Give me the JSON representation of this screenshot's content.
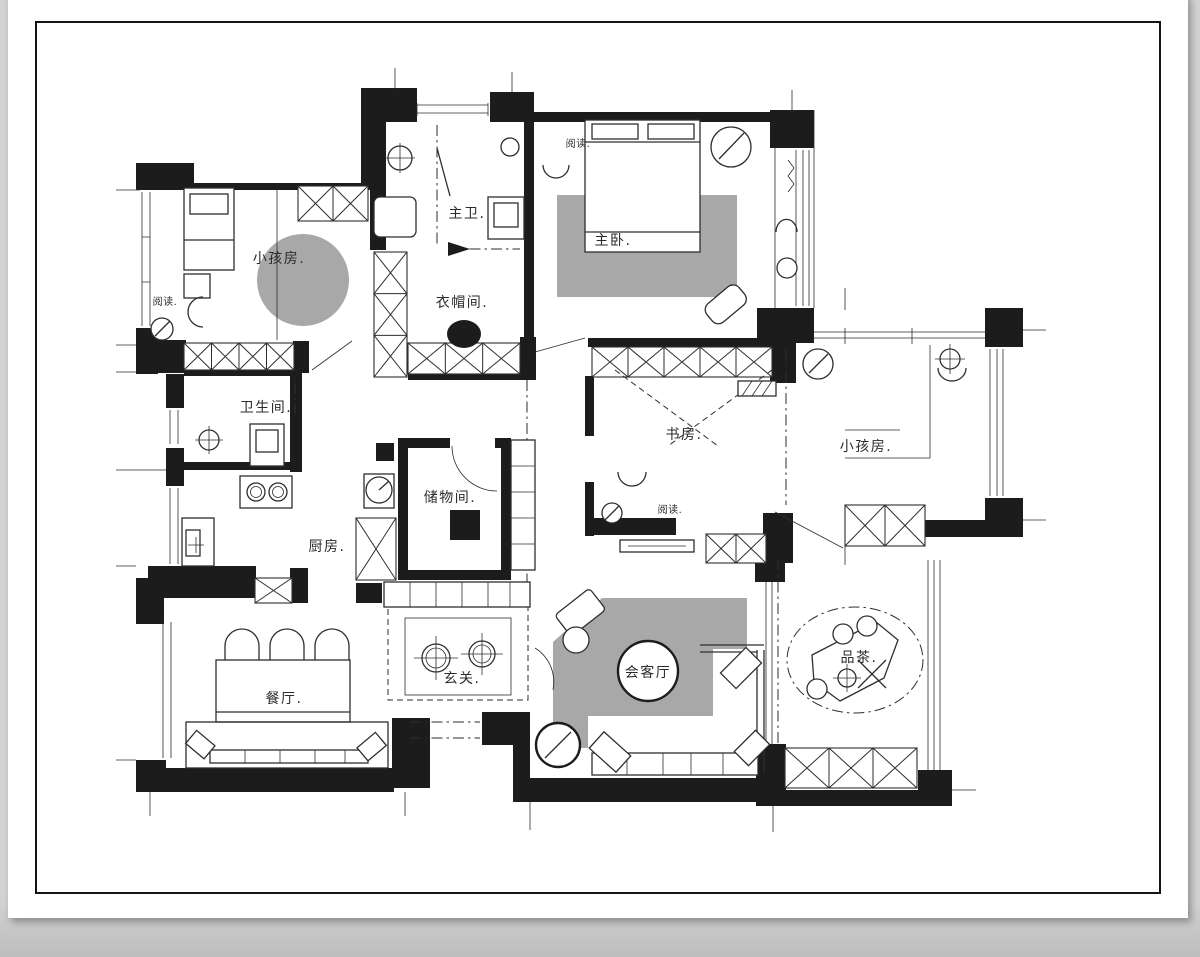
{
  "page": {
    "colors": {
      "background": "#d3d3d3",
      "sheet": "#ffffff",
      "frame": "#141414",
      "ink": "#1c1c1c",
      "line": "#2e2e2e",
      "rug": "#a8a8a8",
      "label": "#2b2b2b"
    }
  },
  "plan": {
    "rooms": [
      {
        "id": "kids-room-1",
        "label": "小孩房."
      },
      {
        "id": "master-bath",
        "label": "主卫."
      },
      {
        "id": "master-bedroom",
        "label": "主卧."
      },
      {
        "id": "walk-in-closet",
        "label": "衣帽间."
      },
      {
        "id": "bathroom",
        "label": "卫生间."
      },
      {
        "id": "study",
        "label": "书房."
      },
      {
        "id": "kids-room-2",
        "label": "小孩房."
      },
      {
        "id": "storage-room",
        "label": "储物间."
      },
      {
        "id": "kitchen",
        "label": "厨房."
      },
      {
        "id": "dining-room",
        "label": "餐厅."
      },
      {
        "id": "foyer",
        "label": "玄关."
      },
      {
        "id": "living-room",
        "label": "会客厅"
      },
      {
        "id": "tea-area",
        "label": "品茶."
      }
    ],
    "annotations": [
      {
        "id": "reading-kids-room-1",
        "label": "阅读."
      },
      {
        "id": "reading-master-bedroom",
        "label": "阅读."
      },
      {
        "id": "reading-study",
        "label": "阅读."
      }
    ]
  }
}
